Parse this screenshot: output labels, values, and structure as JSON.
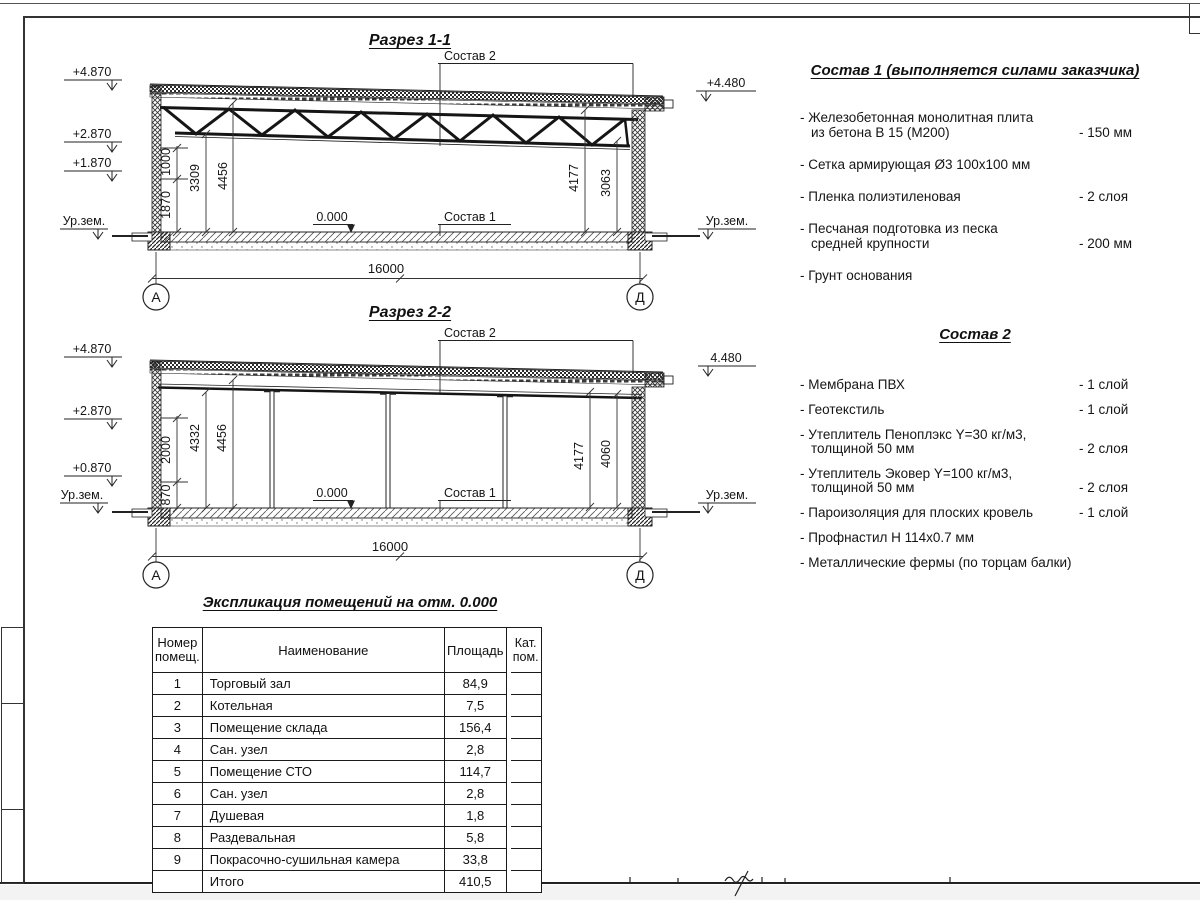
{
  "sec1": {
    "title": "Разрез 1-1",
    "sostav2_label": "Состав 2",
    "sostav1_label": "Состав 1",
    "zero_label": "0.000",
    "span": "16000",
    "axis_left": "А",
    "axis_right": "Д",
    "elev": {
      "l1": "+4.870",
      "l2": "+2.870",
      "l3": "+1.870",
      "lg": "Ур.зем.",
      "r1": "+4.480",
      "rg": "Ур.зем."
    },
    "dims": {
      "a": "1000",
      "b": "1870",
      "c": "3309",
      "d": "4456",
      "e": "4177",
      "f": "3063"
    }
  },
  "sec2": {
    "title": "Разрез 2-2",
    "sostav2_label": "Состав 2",
    "sostav1_label": "Состав 1",
    "zero_label": "0.000",
    "span": "16000",
    "axis_left": "А",
    "axis_right": "Д",
    "elev": {
      "l1": "+4.870",
      "l2": "+2.870",
      "l3": "+0.870",
      "lg": "Ур.зем.",
      "r1": "4.480",
      "rg": "Ур.зем."
    },
    "dims": {
      "a": "2000",
      "b": "870",
      "c": "4332",
      "d": "4456",
      "e": "4177",
      "f": "4060"
    }
  },
  "sostav1": {
    "title": "Состав 1 (выполняется силами заказчика)",
    "items": [
      {
        "text": "- Железобетонная  монолитная плита\nиз бетона В 15 (М200)",
        "value": "- 150 мм"
      },
      {
        "text": "- Сетка армирующая Ø3 100х100 мм",
        "value": ""
      },
      {
        "text": "- Пленка полиэтиленовая",
        "value": "- 2 слоя"
      },
      {
        "text": "- Песчаная подготовка из песка\nсредней крупности",
        "value": "- 200 мм"
      },
      {
        "text": "- Грунт основания",
        "value": ""
      }
    ]
  },
  "sostav2": {
    "title": "Состав 2",
    "items": [
      {
        "text": "- Мембрана ПВХ",
        "value": "- 1 слой"
      },
      {
        "text": "- Геотекстиль",
        "value": "- 1 слой"
      },
      {
        "text": "- Утеплитель Пеноплэкс Y=30 кг/м3,\nтолщиной 50 мм",
        "value": "- 2 слоя"
      },
      {
        "text": "- Утеплитель Эковер Y=100 кг/м3,\nтолщиной 50 мм",
        "value": "- 2 слоя"
      },
      {
        "text": "- Пароизоляция для плоских кровель",
        "value": "- 1 слой"
      },
      {
        "text": "- Профнастил Н 114х0.7 мм",
        "value": ""
      },
      {
        "text": "- Металлические фермы (по торцам балки)",
        "value": ""
      }
    ]
  },
  "table": {
    "title": "Экспликация помещений на отм. 0.000",
    "headers": {
      "h1": "Номер\nпомещ.",
      "h2": "Наименование",
      "h3": "Площадь",
      "h4": "Кат.\nпом."
    },
    "rows": [
      {
        "n": "1",
        "name": "Торговый зал",
        "area": "84,9",
        "kat": ""
      },
      {
        "n": "2",
        "name": "Котельная",
        "area": "7,5",
        "kat": ""
      },
      {
        "n": "3",
        "name": "Помещение склада",
        "area": "156,4",
        "kat": ""
      },
      {
        "n": "4",
        "name": "Сан. узел",
        "area": "2,8",
        "kat": ""
      },
      {
        "n": "5",
        "name": "Помещение СТО",
        "area": "114,7",
        "kat": ""
      },
      {
        "n": "6",
        "name": "Сан. узел",
        "area": "2,8",
        "kat": ""
      },
      {
        "n": "7",
        "name": "Душевая",
        "area": "1,8",
        "kat": ""
      },
      {
        "n": "8",
        "name": "Раздевальная",
        "area": "5,8",
        "kat": ""
      },
      {
        "n": "9",
        "name": "Покрасочно-сушильная камера",
        "area": "33,8",
        "kat": ""
      },
      {
        "n": "",
        "name": "Итого",
        "area": "410,5",
        "kat": ""
      }
    ]
  }
}
